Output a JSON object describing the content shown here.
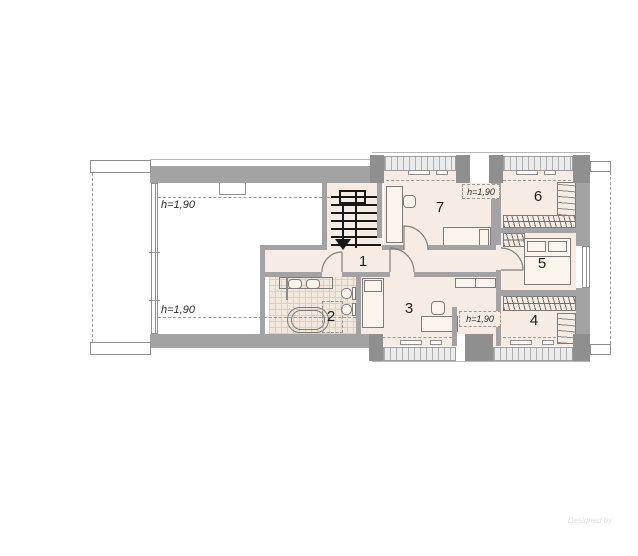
{
  "plan": {
    "rooms": {
      "r1": "1",
      "r2": "2",
      "r3": "3",
      "r4": "4",
      "r5": "5",
      "r6": "6",
      "r7": "7"
    },
    "height_marks": {
      "open_top": "h=1,90",
      "open_bottom": "h=1,90",
      "dormer_top": "h=1,90",
      "dormer_bottom": "h=1,90"
    },
    "watermark": {
      "credit": "Designed by"
    }
  }
}
